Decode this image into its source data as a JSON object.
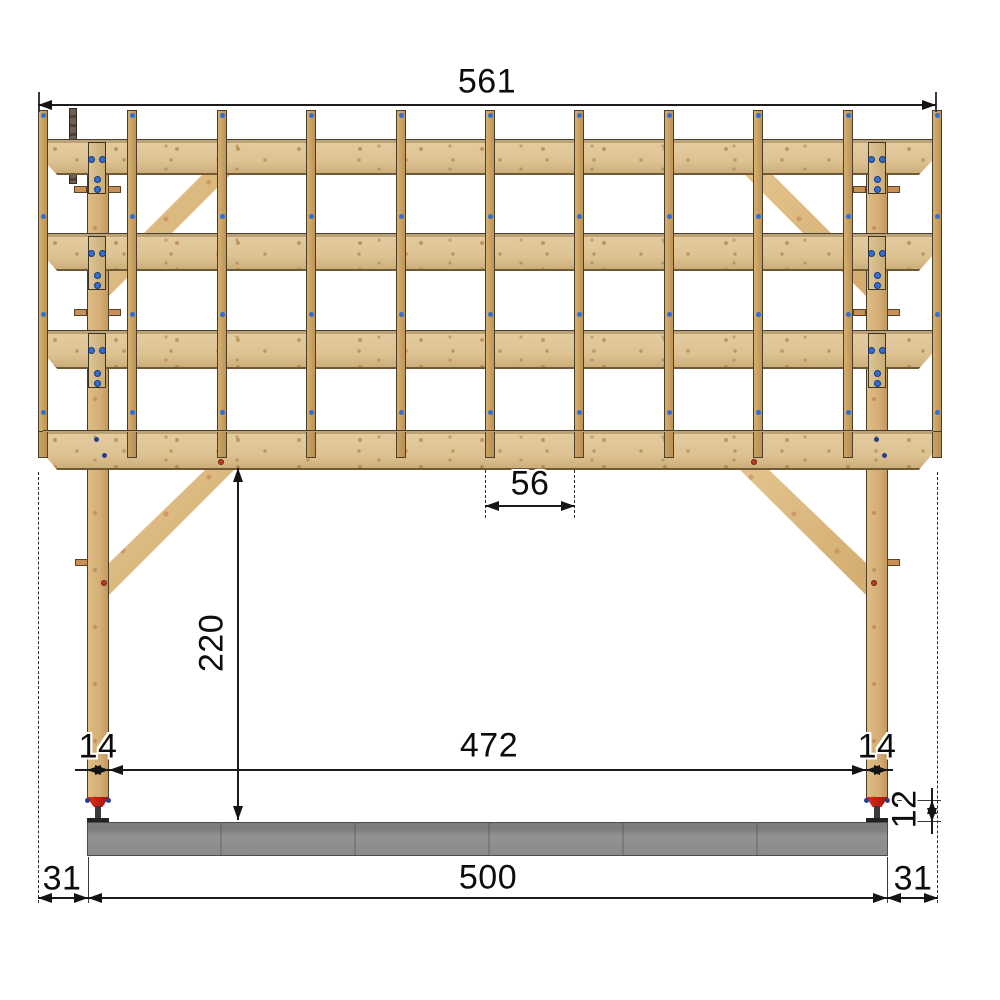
{
  "drawing": {
    "type": "timber-frame front elevation with dimensions",
    "dimensions": {
      "top_overall": "561",
      "rafter_spacing": "56",
      "post_height": "220",
      "left_post_width": "14",
      "clear_span": "472",
      "right_post_width": "14",
      "post_base_height": "12",
      "left_overhang": "31",
      "foundation_length": "500",
      "right_overhang": "31"
    },
    "structure": {
      "rafter_count": 11,
      "beam_count": 4,
      "post_count": 2,
      "brace_count": 4
    },
    "colors": {
      "beam_wood": "#ddc292",
      "rafter_wood": "#c9a263",
      "post_wood": "#d5b077",
      "brace_wood": "#dcbb82",
      "screw_blue": "#2f6fd6",
      "anchor_red": "#c9261a",
      "concrete_gray": "#8b8b8b",
      "dimension_ink": "#1c1c1c",
      "background": "#ffffff"
    }
  }
}
